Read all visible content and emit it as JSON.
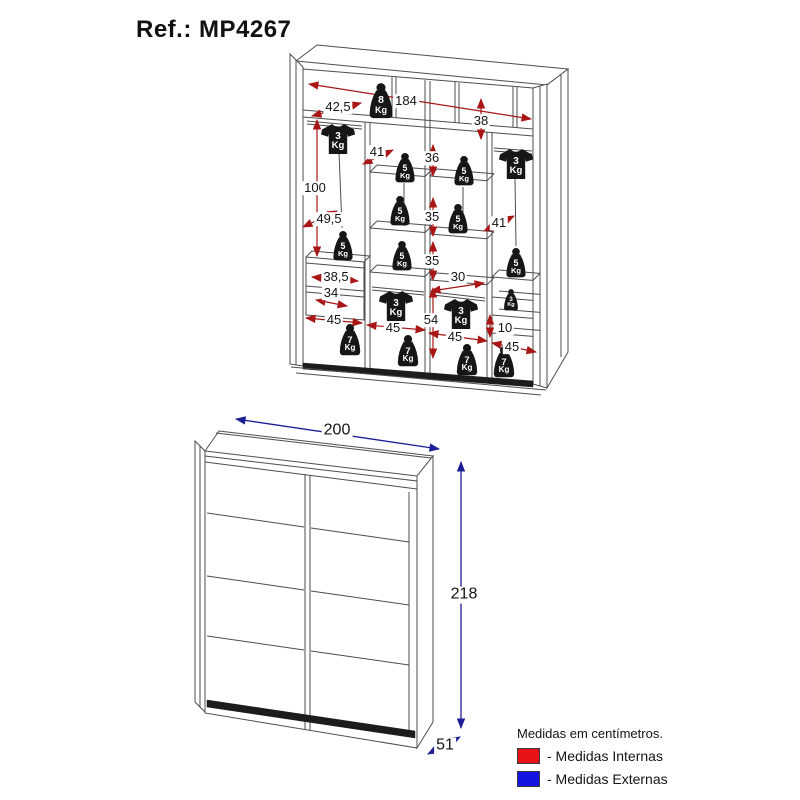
{
  "title": "Ref.: MP4267",
  "legend": {
    "note": "Medidas em centímetros.",
    "internas": {
      "label": "- Medidas Internas",
      "color": "#e81219"
    },
    "externas": {
      "label": "- Medidas Externas",
      "color": "#1414e0"
    }
  },
  "colors": {
    "internal_dims_arrow": "#a81616",
    "external_dims_arrow": "#1d1d96",
    "furniture_line": "#4d4d4d",
    "load_icon": "#161616"
  },
  "internal_view": {
    "kg_unit": "Kg",
    "dimensions": [
      {
        "text": "184",
        "x": 406,
        "y": 101
      },
      {
        "text": "42,5",
        "x": 338,
        "y": 107
      },
      {
        "text": "38",
        "x": 481,
        "y": 121
      },
      {
        "text": "100",
        "x": 315,
        "y": 188
      },
      {
        "text": "41",
        "x": 377,
        "y": 152
      },
      {
        "text": "36",
        "x": 432,
        "y": 158
      },
      {
        "text": "49,5",
        "x": 329,
        "y": 219
      },
      {
        "text": "41",
        "x": 499,
        "y": 223
      },
      {
        "text": "35",
        "x": 432,
        "y": 217
      },
      {
        "text": "35",
        "x": 432,
        "y": 261
      },
      {
        "text": "30",
        "x": 458,
        "y": 277
      },
      {
        "text": "38,5",
        "x": 336,
        "y": 277
      },
      {
        "text": "34",
        "x": 331,
        "y": 293
      },
      {
        "text": "54",
        "x": 431,
        "y": 320
      },
      {
        "text": "45",
        "x": 334,
        "y": 320
      },
      {
        "text": "45",
        "x": 393,
        "y": 328
      },
      {
        "text": "45",
        "x": 455,
        "y": 337
      },
      {
        "text": "10",
        "x": 505,
        "y": 328
      },
      {
        "text": "45",
        "x": 512,
        "y": 347
      }
    ],
    "loads": [
      {
        "kg": "8",
        "type": "weight",
        "x": 381,
        "y": 101,
        "s": 0.95
      },
      {
        "kg": "3",
        "type": "shirt",
        "x": 338,
        "y": 139,
        "s": 1
      },
      {
        "kg": "3",
        "type": "shirt",
        "x": 516,
        "y": 164,
        "s": 1
      },
      {
        "kg": "5",
        "type": "weight",
        "x": 405,
        "y": 168,
        "s": 0.8
      },
      {
        "kg": "5",
        "type": "weight",
        "x": 464,
        "y": 171,
        "s": 0.8
      },
      {
        "kg": "5",
        "type": "weight",
        "x": 400,
        "y": 211,
        "s": 0.8
      },
      {
        "kg": "5",
        "type": "weight",
        "x": 458,
        "y": 219,
        "s": 0.8
      },
      {
        "kg": "5",
        "type": "weight",
        "x": 343,
        "y": 246,
        "s": 0.8
      },
      {
        "kg": "5",
        "type": "weight",
        "x": 402,
        "y": 256,
        "s": 0.8
      },
      {
        "kg": "5",
        "type": "weight",
        "x": 516,
        "y": 263,
        "s": 0.8
      },
      {
        "kg": "3",
        "type": "shirt",
        "x": 396,
        "y": 306,
        "s": 1
      },
      {
        "kg": "3",
        "type": "shirt",
        "x": 461,
        "y": 314,
        "s": 1
      },
      {
        "kg": "3",
        "type": "weight",
        "x": 511,
        "y": 300,
        "s": 0.58
      },
      {
        "kg": "7",
        "type": "weight",
        "x": 350,
        "y": 340,
        "s": 0.85
      },
      {
        "kg": "7",
        "type": "weight",
        "x": 408,
        "y": 351,
        "s": 0.85
      },
      {
        "kg": "7",
        "type": "weight",
        "x": 467,
        "y": 360,
        "s": 0.85
      },
      {
        "kg": "7",
        "type": "weight",
        "x": 504,
        "y": 362,
        "s": 0.85
      }
    ]
  },
  "external_view": {
    "dimensions": [
      {
        "text": "200",
        "x": 337,
        "y": 431
      },
      {
        "text": "218",
        "x": 464,
        "y": 595
      },
      {
        "text": "51",
        "x": 445,
        "y": 746
      }
    ]
  }
}
